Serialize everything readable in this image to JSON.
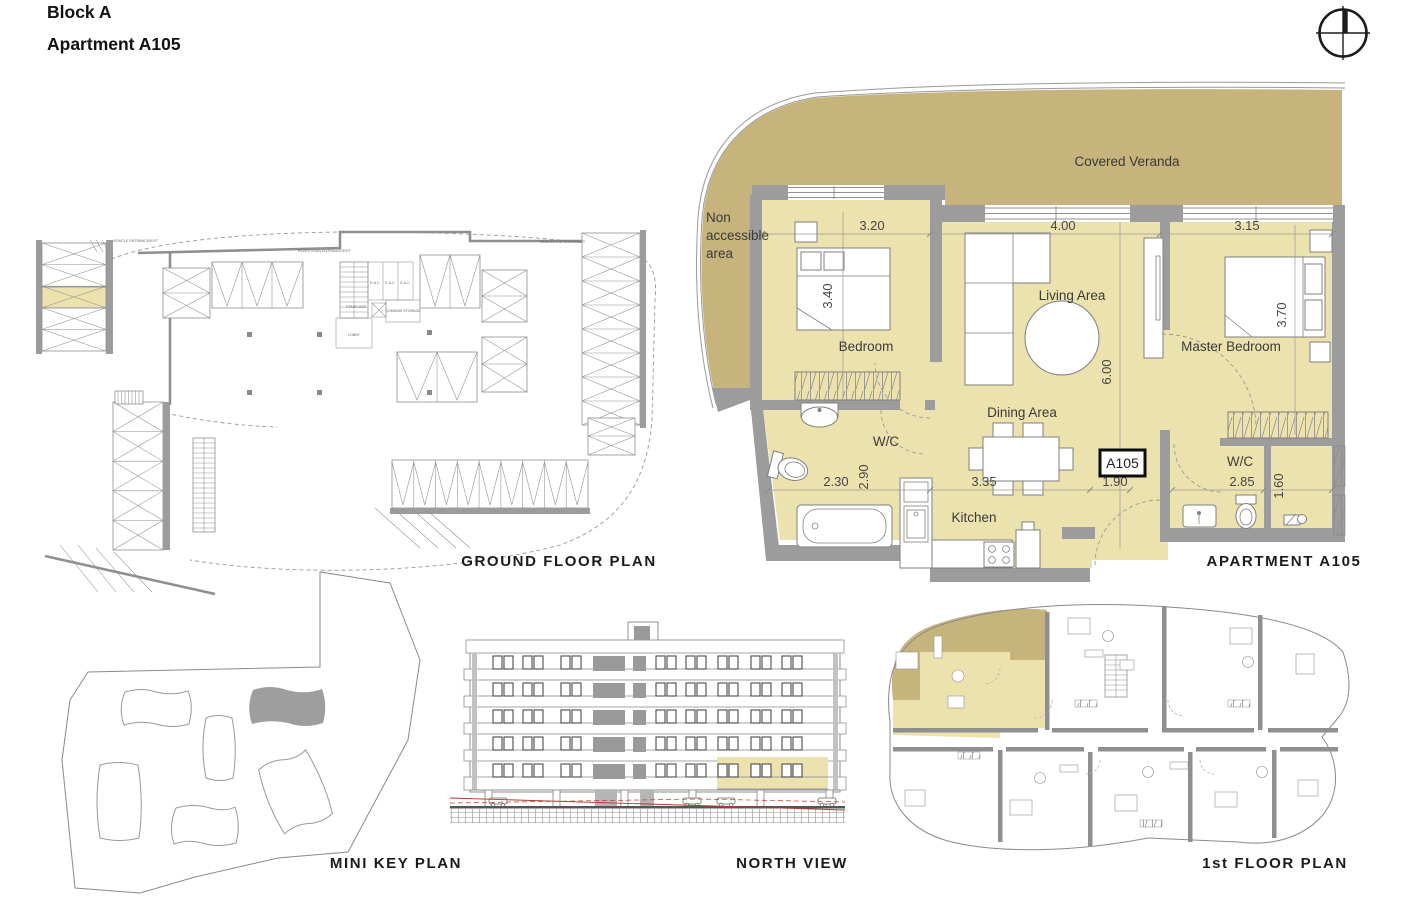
{
  "page": {
    "title_block": "Block A",
    "title_apartment": "Apartment A105"
  },
  "captions": {
    "ground_floor": "GROUND FLOOR PLAN",
    "apartment": "APARTMENT A105",
    "mini_key": "MINI KEY PLAN",
    "north_view": "NORTH VIEW",
    "first_floor": "1st FLOOR PLAN"
  },
  "apartment_plan": {
    "unit_badge": "A105",
    "labels": {
      "covered_veranda": "Covered Veranda",
      "non_accessible": [
        "Non",
        "accessible",
        "area"
      ],
      "bedroom": "Bedroom",
      "living_area": "Living Area",
      "master_bedroom": "Master Bedroom",
      "dining_area": "Dining Area",
      "wc_left": "W/C",
      "wc_right": "W/C",
      "kitchen": "Kitchen"
    },
    "dimensions": {
      "bedroom_width": "3.20",
      "living_width": "4.00",
      "master_width": "3.15",
      "bedroom_depth": "3.40",
      "master_depth": "3.70",
      "living_depth": "6.00",
      "wc_width": "2.30",
      "wc_depth": "2.90",
      "dining_width": "3.35",
      "entrance_width": "1.90",
      "wc2_width": "2.85",
      "shower_width": "1.60"
    }
  },
  "ground_plan_labels": {
    "vehicle_entrance": "VEHICLE ENTRANCE/EXIT",
    "pedestrian_entrance": "PEDESTRIAN ENTRANCE/EXIT",
    "staircase": "STAIRCASE",
    "lobby": "LOBBY",
    "common_storage": "COMMON STORAGE",
    "eac": "E.A.C"
  },
  "colors": {
    "room_fill": "#ece2ae",
    "veranda_fill": "#c6b47c",
    "wall_gray": "#9c9c9c",
    "key_highlight": "#9e9e9e",
    "survey_red": "#b03a2e"
  }
}
